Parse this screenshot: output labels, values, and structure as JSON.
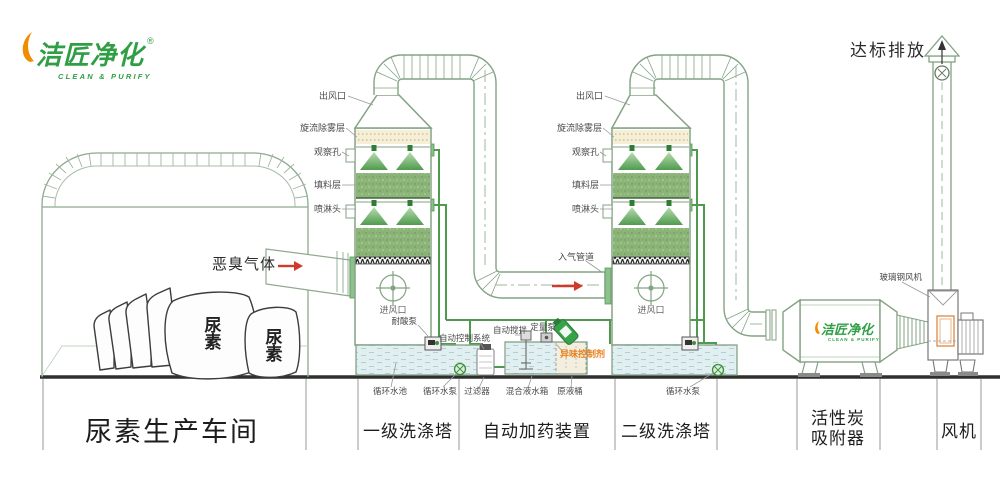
{
  "brand": {
    "name": "洁匠净化",
    "reg": "®",
    "subtitle": "CLEAN & PURIFY"
  },
  "emission": {
    "label": "达标排放"
  },
  "workshop": {
    "gas_label": "恶臭气体",
    "bag_label": "尿素"
  },
  "tower": {
    "outlet": "出风口",
    "demister": "旋流除雾层",
    "viewport": "观察孔",
    "packing": "填料层",
    "spray_head": "喷淋头",
    "air_inlet": "进风口",
    "inlet_duct": "入气管道"
  },
  "dosing": {
    "acid_pump": "耐酸泵",
    "control_system": "自动控制系统",
    "auto_stir": "自动搅拌",
    "metering_pump": "定量泵",
    "odor_agent": "异味控制剂",
    "circ_pool": "循环水池",
    "circ_pump": "循环水泵",
    "filter": "过滤器",
    "mixing_tank": "混合液水箱",
    "raw_barrel": "原液桶"
  },
  "fan_area": {
    "frp_fan": "玻璃钢风机"
  },
  "sections": {
    "workshop": "尿素生产车间",
    "tower1": "一级洗涤塔",
    "dosing": "自动加药装置",
    "tower2": "二级洗涤塔",
    "carbon_line1": "活性炭",
    "carbon_line2": "吸附器",
    "fan": "风机"
  },
  "colors": {
    "line_green": "#84a284",
    "pipe_green": "#4e9a4e",
    "packing_green": "#8cb478",
    "brand_green": "#2f9e44",
    "brand_orange": "#f08c00",
    "accent_red": "#cf3a2b",
    "agent_orange": "#e8821e",
    "cream": "#f5efd8"
  }
}
